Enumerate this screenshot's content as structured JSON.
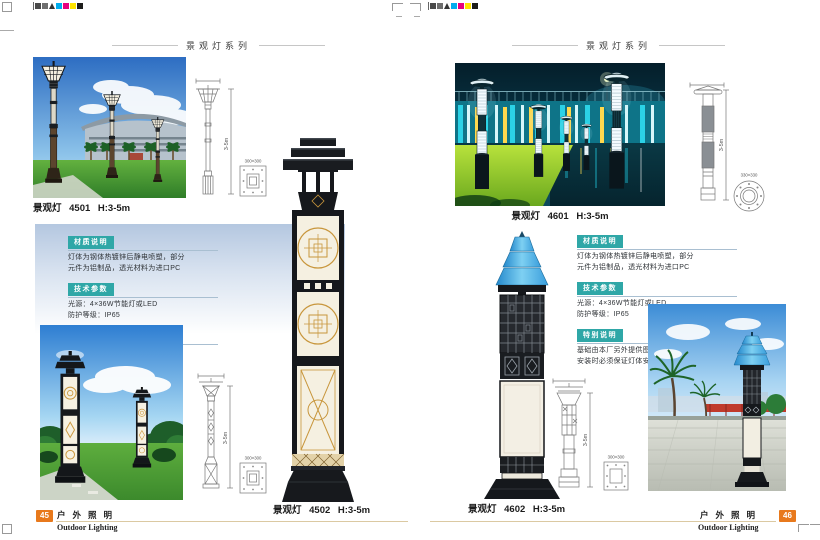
{
  "print_marks": {
    "color_bar": [
      "#00adee",
      "#e6007e",
      "#ffe400",
      "#1d1d1b"
    ]
  },
  "colors": {
    "badge_teal": "#2fa7a7",
    "page_badge_orange": "#e8791c",
    "footer_rule_tan": "#dbc9a2",
    "panel_blue": "#b4c7e0"
  },
  "pages": {
    "left": {
      "header_title": "景观灯系列",
      "product_top": {
        "label": "景观灯 4501 H:3-5m",
        "dim_height": "3-5m",
        "base_size": "300×300"
      },
      "product_bottom": {
        "label": "景观灯 4502 H:3-5m",
        "dim_height": "3-5m",
        "base_size": "300×300"
      },
      "info": {
        "sections": [
          {
            "title": "材质说明",
            "line1": "灯体为钢体热镀锌后静电喷塑，部分",
            "line2": "元件为铝制品，透光材料为进口PC"
          },
          {
            "title": "技术参数",
            "line1": "光源：4×36W节能灯或LED",
            "line2": "防护等级：IP65"
          },
          {
            "title": "特别说明",
            "line1": "基础由本厂另外提供图纸制作",
            "line2": "安装时必须保证灯体安全接地"
          }
        ]
      },
      "footer": {
        "page_number": "45",
        "title_cn": "户外照明",
        "title_en": "Outdoor Lighting"
      }
    },
    "right": {
      "header_title": "景观灯系列",
      "product_top": {
        "label": "景观灯 4601 H:3-5m",
        "dim_height": "3-5m",
        "base_size": "330×330"
      },
      "product_bottom": {
        "label": "景观灯 4602 H:3-5m",
        "dim_height": "3-5m",
        "base_size": "300×300"
      },
      "info": {
        "sections": [
          {
            "title": "材质说明",
            "line1": "灯体为钢体热镀锌后静电喷塑，部分",
            "line2": "元件为铝制品，透光材料为进口PC"
          },
          {
            "title": "技术参数",
            "line1": "光源：4×36W节能灯或LED",
            "line2": "防护等级：IP65"
          },
          {
            "title": "特别说明",
            "line1": "基础由本厂另外提供图纸制作",
            "line2": "安装时必须保证灯体安全接地"
          }
        ]
      },
      "footer": {
        "page_number": "46",
        "title_cn": "户外照明",
        "title_en": "Outdoor Lighting"
      }
    }
  }
}
